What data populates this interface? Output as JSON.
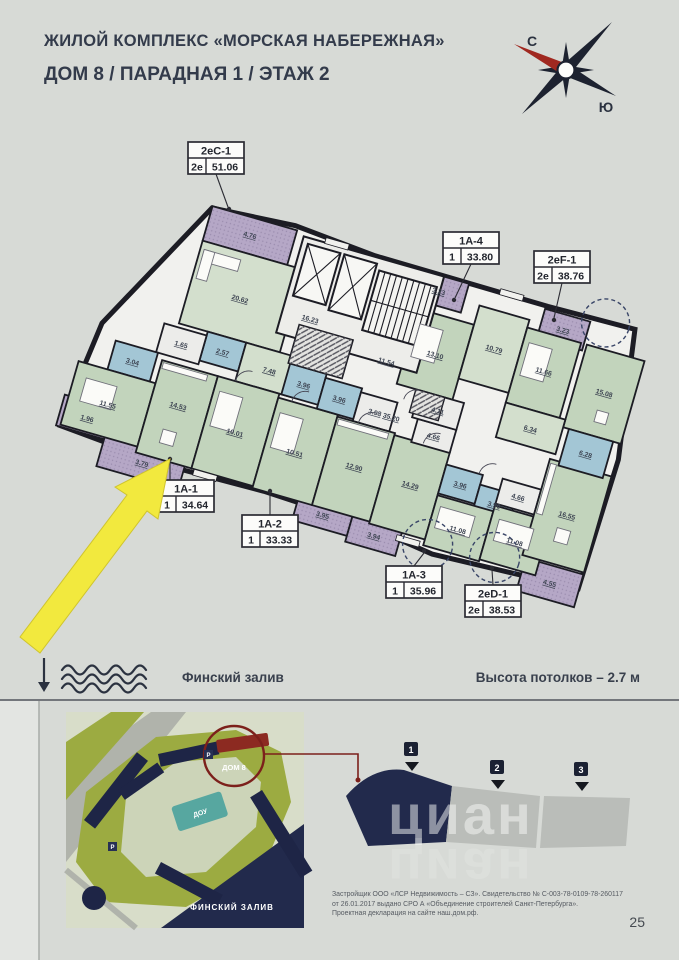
{
  "header": {
    "title": "ЖИЛОЙ КОМПЛЕКС «МОРСКАЯ НАБЕРЕЖНАЯ»",
    "subtitle": "ДОМ 8 / ПАРАДНАЯ 1 / ЭТАЖ 2"
  },
  "compass": {
    "north": "С",
    "south": "Ю"
  },
  "apartments": [
    {
      "id": "2еС-1",
      "type": "2е",
      "area": "51.06"
    },
    {
      "id": "1А-4",
      "type": "1",
      "area": "33.80"
    },
    {
      "id": "2еF-1",
      "type": "2е",
      "area": "38.76"
    },
    {
      "id": "1А-1",
      "type": "1",
      "area": "34.64"
    },
    {
      "id": "1А-2",
      "type": "1",
      "area": "33.33"
    },
    {
      "id": "1А-3",
      "type": "1",
      "area": "35.96"
    },
    {
      "id": "2еD-1",
      "type": "2е",
      "area": "38.53"
    }
  ],
  "room_areas": [
    "4.76",
    "20.62",
    "2.57",
    "1.65",
    "7.48",
    "3.04",
    "11.55",
    "1.96",
    "14.53",
    "3.79",
    "10.01",
    "10.51",
    "3.96",
    "3.96",
    "3.98",
    "12.90",
    "16.23",
    "11.54",
    "35.20",
    "13.10",
    "10.79",
    "4.11",
    "3.23",
    "11.66",
    "3.23",
    "15.08",
    "6.34",
    "6.28",
    "14.29",
    "4.66",
    "3.96",
    "3.96",
    "11.08",
    "3.95",
    "3.94",
    "4.66",
    "11.08",
    "16.55",
    "4.55"
  ],
  "legend": {
    "gulf": "Финский залив",
    "ceiling": "Высота потолков – 2.7 м"
  },
  "site_map": {
    "building": "ДОМ 8",
    "kindergarten": "ДОУ",
    "water": "ФИНСКИЙ ЗАЛИВ",
    "parking": "P"
  },
  "sections": [
    {
      "num": "1"
    },
    {
      "num": "2"
    },
    {
      "num": "3"
    }
  ],
  "footer": {
    "disclaimer": [
      "Застройщик ООО «ЛСР Недвижимость – СЗ». Свидетельство № С-003-78-0109-78-260117",
      "от 26.01.2017 выдано СРО А «Объединение строителей Санкт-Петербурга».",
      "Проектная декларация на сайте наш.дом.рф."
    ],
    "page_number": "25",
    "watermark": "циан"
  },
  "colors": {
    "page_bg": "#d7dad6",
    "walls": "#1c1c24",
    "room_green": "#c2d4bc",
    "room_green_light": "#d3dfcd",
    "bathroom_blue": "#a3c6d5",
    "balcony_purple": "#b5a7c6",
    "highlight_yellow": "#f2e93e",
    "navy": "#222a4c",
    "map_green": "#9cab41",
    "accent_red": "#7c201b"
  }
}
